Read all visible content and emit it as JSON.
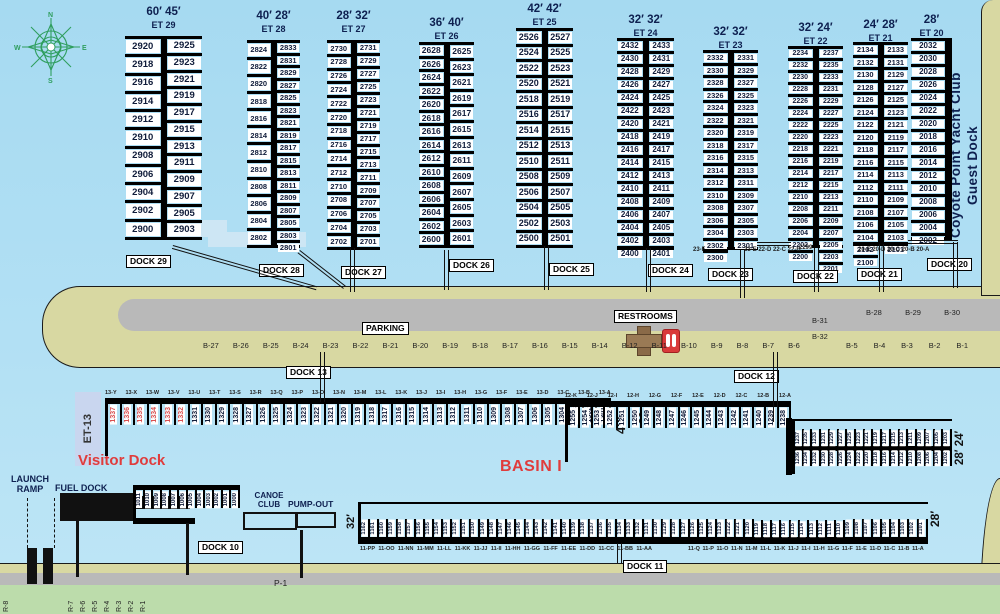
{
  "colors": {
    "water": "#aadcf2",
    "land": "#d8d8a2",
    "road": "#b9b9b9",
    "green": "#bcdcab",
    "accent_red": "#e03c3c",
    "navy": "#0e2050",
    "slip_red": "#d95050"
  },
  "yacht_club": {
    "line1": "Coyote Point Yacht Club",
    "line2": "Guest Dock"
  },
  "middle": {
    "parking_label": "PARKING",
    "restrooms_label": "RESTROOMS"
  },
  "basin_label": "BASIN I",
  "visitor_dock_label": "Visitor Dock",
  "et13_label": "ET-13",
  "p1_label": "P-1",
  "facilities": {
    "launch_ramp_l1": "LAUNCH",
    "launch_ramp_l2": "RAMP",
    "fuel_dock": "FUEL DOCK",
    "canoe_l1": "CANOE",
    "canoe_l2": "CLUB",
    "pump_out": "PUMP-OUT"
  },
  "dock_boxes": {
    "dock13": "DOCK 13",
    "dock12": "DOCK 12",
    "dock11": "DOCK 11",
    "dock10": "DOCK 10"
  },
  "sizes": {
    "dock13_outer": "40′",
    "dock13_inner": "36′",
    "dock11_left": "32′",
    "dock11_right": "28′",
    "dock12b_right": "28′ 24′"
  },
  "top_docks": [
    {
      "id": "d29",
      "widths": "60′  45′",
      "et": "ET 29",
      "dock_label": "DOCK 29",
      "left": [
        "2920",
        "2918",
        "2916",
        "2914",
        "2912",
        "2910",
        "2908",
        "2906",
        "2904",
        "2902",
        "2900"
      ],
      "right": [
        "2925",
        "2923",
        "2921",
        "2919",
        "2917",
        "2915",
        "2913",
        "2911",
        "2909",
        "2907",
        "2905",
        "2903"
      ]
    },
    {
      "id": "d28",
      "widths": "40′ 28′",
      "et": "ET 28",
      "dock_label": "DOCK 28",
      "left": [
        "2824",
        "2822",
        "2820",
        "2818",
        "2816",
        "2814",
        "2812",
        "2810",
        "2808",
        "2806",
        "2804",
        "2802"
      ],
      "right": [
        "2833",
        "2831",
        "2829",
        "2827",
        "2825",
        "2823",
        "2821",
        "2819",
        "2817",
        "2815",
        "2813",
        "2811",
        "2809",
        "2807",
        "2805",
        "2803",
        "2801"
      ]
    },
    {
      "id": "d27",
      "widths": "28′ 32′",
      "et": "ET 27",
      "dock_label": "DOCK 27",
      "left": [
        "2730",
        "2728",
        "2726",
        "2724",
        "2722",
        "2720",
        "2718",
        "2716",
        "2714",
        "2712",
        "2710",
        "2708",
        "2706",
        "2704",
        "2702"
      ],
      "right": [
        "2731",
        "2729",
        "2727",
        "2725",
        "2723",
        "2721",
        "2719",
        "2717",
        "2715",
        "2713",
        "2711",
        "2709",
        "2707",
        "2705",
        "2703",
        "2701"
      ]
    },
    {
      "id": "d26",
      "widths": "36′ 40′",
      "et": "ET 26",
      "dock_label": "DOCK 26",
      "left": [
        "2628",
        "2626",
        "2624",
        "2622",
        "2620",
        "2618",
        "2616",
        "2614",
        "2612",
        "2610",
        "2608",
        "2606",
        "2604",
        "2602",
        "2600"
      ],
      "right": [
        "2625",
        "2623",
        "2621",
        "2619",
        "2617",
        "2615",
        "2613",
        "2611",
        "2609",
        "2607",
        "2605",
        "2603",
        "2601"
      ]
    },
    {
      "id": "d25",
      "widths": "42′ 42′",
      "et": "ET 25",
      "dock_label": "DOCK 25",
      "left": [
        "2526",
        "2524",
        "2522",
        "2520",
        "2518",
        "2516",
        "2514",
        "2512",
        "2510",
        "2508",
        "2506",
        "2504",
        "2502",
        "2500"
      ],
      "right": [
        "2527",
        "2525",
        "2523",
        "2521",
        "2519",
        "2517",
        "2515",
        "2513",
        "2511",
        "2509",
        "2507",
        "2505",
        "2503",
        "2501"
      ]
    },
    {
      "id": "d24",
      "widths": "32′ 32′",
      "et": "ET 24",
      "dock_label": "DOCK 24",
      "left": [
        "2432",
        "2430",
        "2428",
        "2426",
        "2424",
        "2422",
        "2420",
        "2418",
        "2416",
        "2414",
        "2412",
        "2410",
        "2408",
        "2406",
        "2404",
        "2402",
        "2400"
      ],
      "right": [
        "2433",
        "2431",
        "2429",
        "2427",
        "2425",
        "2423",
        "2421",
        "2419",
        "2417",
        "2415",
        "2413",
        "2411",
        "2409",
        "2407",
        "2405",
        "2403",
        "2401"
      ]
    },
    {
      "id": "d23",
      "widths": "32′ 32′",
      "et": "ET 23",
      "dock_label": "DOCK 23",
      "left": [
        "2332",
        "2330",
        "2328",
        "2326",
        "2324",
        "2322",
        "2320",
        "2318",
        "2316",
        "2314",
        "2312",
        "2310",
        "2308",
        "2306",
        "2304",
        "2302",
        "2300"
      ],
      "right": [
        "2331",
        "2329",
        "2327",
        "2325",
        "2323",
        "2321",
        "2319",
        "2317",
        "2315",
        "2313",
        "2311",
        "2309",
        "2307",
        "2305",
        "2303",
        "2301"
      ]
    },
    {
      "id": "d22",
      "widths": "32′ 24′",
      "et": "ET 22",
      "dock_label": "DOCK 22",
      "left": [
        "2234",
        "2232",
        "2230",
        "2228",
        "2226",
        "2224",
        "2222",
        "2220",
        "2218",
        "2216",
        "2214",
        "2212",
        "2210",
        "2208",
        "2206",
        "2204",
        "2202",
        "2200"
      ],
      "right": [
        "2237",
        "2235",
        "2233",
        "2231",
        "2229",
        "2227",
        "2225",
        "2223",
        "2221",
        "2219",
        "2217",
        "2215",
        "2213",
        "2211",
        "2209",
        "2207",
        "2205",
        "2203",
        "2201"
      ]
    },
    {
      "id": "d21",
      "widths": "24′ 28′",
      "et": "ET 21",
      "dock_label": "DOCK 21",
      "left": [
        "2134",
        "2132",
        "2130",
        "2128",
        "2126",
        "2124",
        "2122",
        "2120",
        "2118",
        "2116",
        "2114",
        "2112",
        "2110",
        "2108",
        "2106",
        "2104",
        "2102",
        "2100"
      ],
      "right": [
        "2133",
        "2131",
        "2129",
        "2127",
        "2125",
        "2123",
        "2121",
        "2119",
        "2117",
        "2115",
        "2113",
        "2111",
        "2109",
        "2107",
        "2105",
        "2103",
        "2101"
      ]
    },
    {
      "id": "d20",
      "widths": "28′",
      "et": "ET 20",
      "dock_label": "DOCK 20",
      "left": [
        "2032",
        "2030",
        "2028",
        "2026",
        "2024",
        "2022",
        "2020",
        "2018",
        "2016",
        "2014",
        "2012",
        "2010",
        "2008",
        "2006",
        "2004",
        "2002"
      ],
      "right": null
    }
  ],
  "footers": [
    "23-F",
    "23-E 22-D 22-C 22-B",
    "2299",
    "20-E 20-D 20-C 20-B 20-A"
  ],
  "b_spots_row": [
    "B-27",
    "B-26",
    "B-25",
    "B-24",
    "B-23",
    "B-22",
    "B-21",
    "B-20",
    "B-19",
    "B-18",
    "B-17",
    "B-16",
    "B-15",
    "B-14",
    "B-12",
    "B-11",
    "B-10",
    "B-9",
    "B-8",
    "B-7",
    "B-6",
    "B-5",
    "B-4",
    "B-3",
    "B-2",
    "B-1"
  ],
  "b_spots_upper": [
    "B-28",
    "B-29",
    "B-30"
  ],
  "b_spots_mid": [
    "B-31",
    "B-32"
  ],
  "dock13_row": {
    "letters": [
      "13-Y",
      "13-X",
      "13-W",
      "13-V",
      "13-U",
      "13-T",
      "13-S",
      "13-R",
      "13-Q",
      "13-P",
      "13-O",
      "13-N",
      "13-M",
      "13-L",
      "13-K",
      "13-J",
      "13-I",
      "13-H",
      "13-G",
      "13-F",
      "13-E",
      "13-D",
      "13-C",
      "13-B",
      "13-A"
    ],
    "red_slips": [
      "1337",
      "1336",
      "1335",
      "1334",
      "1333",
      "1332"
    ],
    "black_slips": [
      "1331",
      "1330",
      "1329",
      "1328",
      "1327",
      "1326",
      "1325",
      "1324",
      "1323",
      "1322",
      "1321",
      "1320",
      "1319",
      "1318",
      "1317",
      "1316",
      "1315",
      "1314",
      "1313",
      "1312",
      "1311",
      "1310",
      "1309",
      "1308",
      "1307",
      "1306",
      "1305",
      "1304",
      "1303",
      "1302",
      "1301"
    ]
  },
  "dock12_row": {
    "letters": [
      "12-K",
      "12-J",
      "12-I",
      "12-H",
      "12-G",
      "12-F",
      "12-E",
      "12-D",
      "12-C",
      "12-B",
      "12-A"
    ],
    "slips": [
      "1255",
      "1254",
      "1253",
      "1252",
      "1251",
      "1250",
      "1249",
      "1248",
      "1247",
      "1246",
      "1245",
      "1244",
      "1243",
      "1242",
      "1241",
      "1240",
      "1239",
      "1238"
    ]
  },
  "dock12b": {
    "upper": [
      "1237",
      "1235",
      "1233",
      "1231",
      "1229",
      "1227",
      "1225",
      "1223",
      "1221",
      "1219",
      "1217",
      "1215",
      "1213",
      "1211",
      "1209",
      "1207",
      "1205",
      "1203"
    ],
    "lower": [
      "1236",
      "1234",
      "1232",
      "1230",
      "1228",
      "1226",
      "1224",
      "1222",
      "1220",
      "1218",
      "1216",
      "1214",
      "1212",
      "1210",
      "1208",
      "1206",
      "1204",
      "1202"
    ]
  },
  "dock11_row": {
    "slips": [
      "1162",
      "1161",
      "1160",
      "1159",
      "1158",
      "1157",
      "1156",
      "1155",
      "1154",
      "1153",
      "1152",
      "1151",
      "1150",
      "1149",
      "1148",
      "1147",
      "1146",
      "1145",
      "1144",
      "1143",
      "1142",
      "1141",
      "1140",
      "1139",
      "1138",
      "1137",
      "1136",
      "1135",
      "1134",
      "1133",
      "1132",
      "1131",
      "1130",
      "1129",
      "1128",
      "1127",
      "1126",
      "1125",
      "1124",
      "1123",
      "1122",
      "1121",
      "1120",
      "1119",
      "1118",
      "1117",
      "1116",
      "1115",
      "1114",
      "1113",
      "1112",
      "1111",
      "1110",
      "1109",
      "1108",
      "1107",
      "1106",
      "1105",
      "1104",
      "1103",
      "1102",
      "1101"
    ],
    "letters_left": [
      "11-PP",
      "11-OO",
      "11-NN",
      "11-MM",
      "11-LL",
      "11-KK",
      "11-JJ",
      "11-II",
      "11-HH",
      "11-GG",
      "11-FF",
      "11-EE",
      "11-DD",
      "11-CC",
      "11-BB",
      "11-AA"
    ],
    "letters_right": [
      "11-Q",
      "11-P",
      "11-O",
      "11-N",
      "11-M",
      "11-L",
      "11-K",
      "11-J",
      "11-I",
      "11-H",
      "11-G",
      "11-F",
      "11-E",
      "11-D",
      "11-C",
      "11-B",
      "11-A"
    ]
  },
  "fuel_slips": [
    "1011",
    "1010",
    "1009",
    "1008",
    "1007",
    "1006",
    "1005",
    "1004",
    "1003",
    "1002",
    "1001",
    "1000"
  ],
  "r_spots": [
    "R-8",
    "R-7",
    "R-6",
    "R-5",
    "R-4",
    "R-3",
    "R-2",
    "R-1"
  ],
  "compass": {
    "n": "N",
    "e": "E",
    "s": "S",
    "w": "W"
  }
}
